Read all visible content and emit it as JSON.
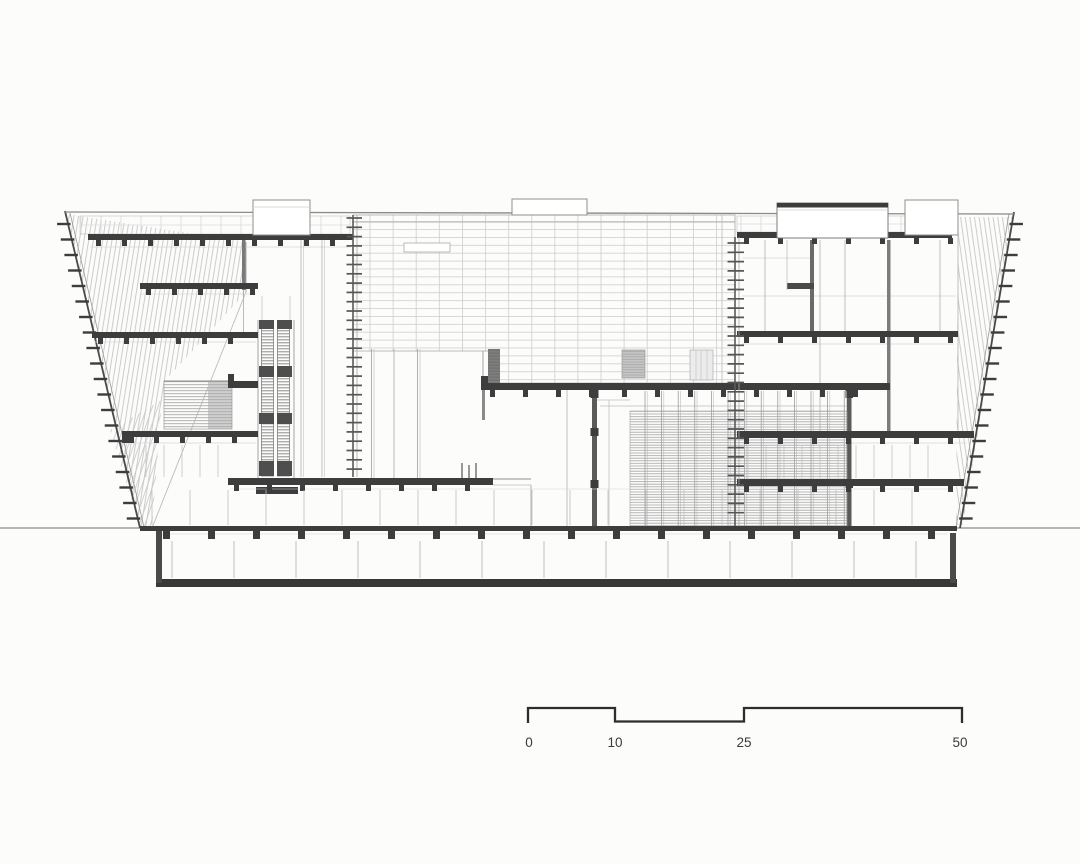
{
  "scale_bar": {
    "labels": [
      "0",
      "10",
      "25",
      "50"
    ]
  },
  "colors": {
    "background": "#fcfcfb",
    "ink_dark": "#3d3d3d",
    "ink_mid": "#8c8c8c",
    "ink_light": "#c7c7c7",
    "ground_line": "#6e6e6e",
    "scale_text": "#3a3a3a"
  }
}
